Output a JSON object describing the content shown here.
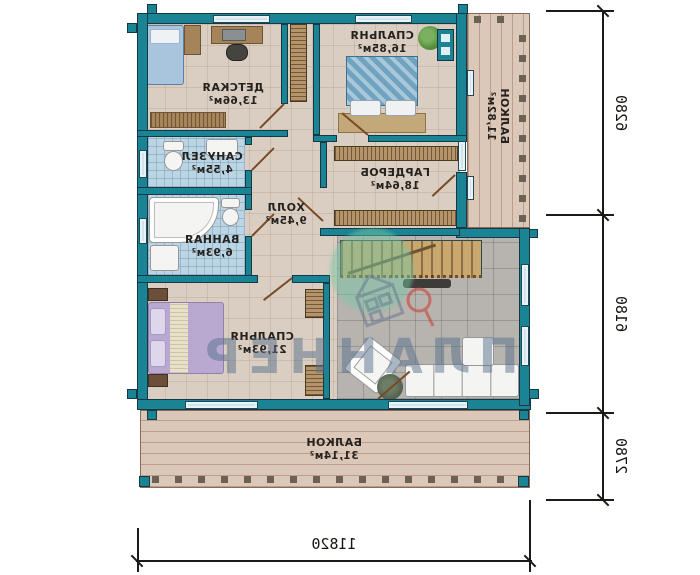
{
  "plan": {
    "rooms": [
      {
        "name": "ДЕТСКАЯ",
        "area": "13,66м²"
      },
      {
        "name": "СПАЛЬНЯ",
        "area": "16,85м²"
      },
      {
        "name": "САНУЗЕЛ",
        "area": "4,55м²"
      },
      {
        "name": "ВАННАЯ",
        "area": "6,93м²"
      },
      {
        "name": "ХОЛЛ",
        "area": "9,45м²"
      },
      {
        "name": "ГАРДЕРОБ",
        "area": "18,64м²"
      },
      {
        "name": "СПАЛЬНЯ",
        "area": "21,93м²"
      },
      {
        "name": "БАЛКОН",
        "area": "11,82м²"
      },
      {
        "name": "БАЛКОН",
        "area": "31,14м²"
      }
    ],
    "dimensions": {
      "right_top": "6280",
      "right_middle": "6180",
      "right_bottom": "2780",
      "bottom_width": "11820"
    },
    "watermark_text": "ПЛАННЕР",
    "colors": {
      "wall": "#1b8494",
      "wall_outline": "#143945",
      "floor_tile": "#d9cec1",
      "bathroom_tile": "#bcd5e4",
      "living_tile": "#b7b3af",
      "deck_wood": "#dcc8b9",
      "dimension_ink": "#1c1a17",
      "watermark": "#58708c",
      "logo_pin": "#c9443a",
      "highlight_green": "#76c8a6"
    }
  }
}
